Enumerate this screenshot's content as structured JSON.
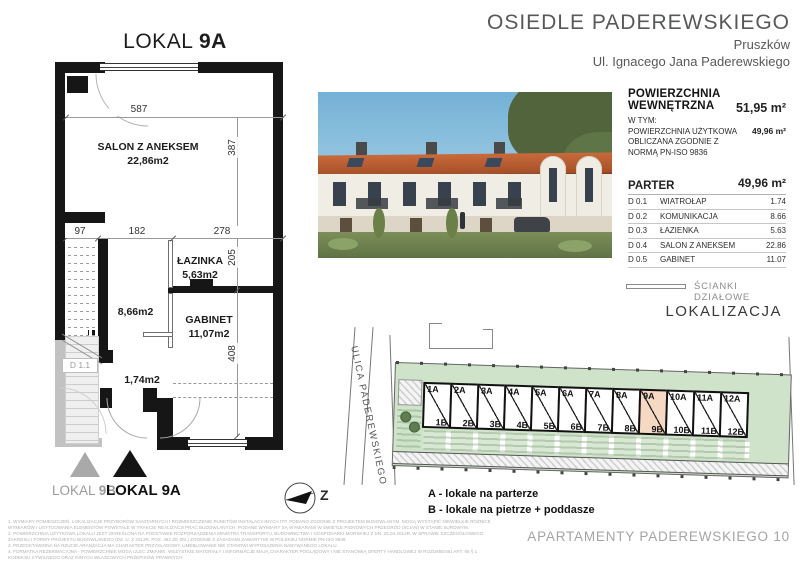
{
  "colors": {
    "wall": "#161616",
    "site_green": "#cfe3cb",
    "unit_highlight": "#f6d9c2",
    "roof_orange": "#b85c33",
    "muted_text": "#57585a"
  },
  "plan": {
    "title_prefix": "LOKAL",
    "title_number": "9A",
    "rooms": {
      "salon_name": "SALON Z ANEKSEM",
      "salon_area": "22,86m2",
      "lazienka_name": "ŁAZINKA",
      "lazienka_area": "5,63m2",
      "komunikacja_area": "8,66m2",
      "gabinet_name": "GABINET",
      "gabinet_area": "11,07m2",
      "wiatrolap_area": "1,74m2",
      "door_tag": "D 1.1"
    },
    "dims": {
      "top": "587",
      "right_upper": "387",
      "w1": "97",
      "w2": "182",
      "w3": "278",
      "right_mid": "205",
      "right_lower": "408"
    },
    "markers": {
      "gray_prefix": "LOKAL ",
      "gray_number": "9B",
      "black_prefix": "LOKAL ",
      "black_number": "9A"
    },
    "compass_letter": "Z"
  },
  "header": {
    "project": "OSIEDLE PADEREWSKIEGO",
    "city": "Pruszków",
    "street": "Ul. Ignacego Jana Paderewskiego"
  },
  "summary": {
    "internal_label": "POWIERZCHNIA WEWNĘTRZNA",
    "internal_value": "51,95 m²",
    "including": "W TYM:",
    "usable_lines": [
      "POWIERZCHNIA UŻYTKOWA",
      "OBLICZANA ZGODNIE Z",
      "NORMĄ PN-ISO 9836"
    ],
    "usable_value": "49,96 m²",
    "floor_label": "PARTER",
    "floor_value": "49,96 m²"
  },
  "room_table": [
    {
      "code": "D 0.1",
      "name": "WIATROŁAP",
      "area": "1.74"
    },
    {
      "code": "D 0.2",
      "name": "KOMUNIKACJA",
      "area": "8.66"
    },
    {
      "code": "D 0.3",
      "name": "ŁAZIENKA",
      "area": "5.63"
    },
    {
      "code": "D 0.4",
      "name": "SALON Z ANEKSEM",
      "area": "22.86"
    },
    {
      "code": "D 0.5",
      "name": "GABINET",
      "area": "11.07"
    }
  ],
  "partition_legend": "ŚCIANKI DZIAŁOWE",
  "location": {
    "title": "LOKALIZACJA",
    "street": "ULICA PADEREWSKIEGO",
    "units": [
      {
        "a": "1A",
        "b": "1B"
      },
      {
        "a": "2A",
        "b": "2B"
      },
      {
        "a": "3A",
        "b": "3B"
      },
      {
        "a": "4A",
        "b": "4B"
      },
      {
        "a": "5A",
        "b": "5B"
      },
      {
        "a": "6A",
        "b": "6B"
      },
      {
        "a": "7A",
        "b": "7B"
      },
      {
        "a": "8A",
        "b": "8B"
      },
      {
        "a": "9A",
        "b": "9B",
        "highlight": true
      },
      {
        "a": "10A",
        "b": "10B"
      },
      {
        "a": "11A",
        "b": "11B"
      },
      {
        "a": "12A",
        "b": "12B"
      }
    ],
    "legend_a": "A - lokale na parterze",
    "legend_b": "B - lokale na pietrze + poddasze"
  },
  "footer": "APARTAMENTY PADEREWSKIEGO 10",
  "disclaimer": [
    "1. WYMIARY POMIESZCZEŃ, LOKALIZACJE PRZYBORÓW SANITARNYCH I ROZMIESZCZENIE PUNKTÓW INSTALACYJNYCH ITP. PODANO ZGODNIE Z PROJEKTEM BUDOWLANYM. MOGĄ WYSTĄPIĆ NIEWIELKIE RÓŻNICE",
    "WYMIARÓW I USYTUOWANIA ELEMENTÓW POWSTAŁE W TRAKCIE REALIZACJI PRAC BUDOWLANYCH. PODANE WYMIARY SĄ WYMIARAMI W ŚWIETLE PIONOWYCH PRZEGRÓD (ŚCIAN) W STANIE SUROWYM.",
    "2. POWIERZCHNIA UŻYTKOWA LOKALU JEST OKREŚLONA NA PODSTAWIE ROZPORZĄDZENIA MINISTRA TRANSPORTU, BUDOWNICTWA I GOSPODARKI MORSKIEJ Z DN. 25.04.2012R. W SPRAWIE SZCZEGÓŁOWEGO",
    "ZAKRESU I FORMY PROJEKTU BUDOWLANEGO (DZ. U. Z 2012R. POZ. 462 ZE ZM.) ZGODNIE Z ZASADAMI ZAWARTYMI W POLSKIEJ NORMIE PN-ISO 9836.",
    "3. PRZEDSTAWIONA NA RZUCIE ARANŻACJA MA CHARAKTER PRZYKŁADOWY. UMEBLOWANIE NIE STANOWI WYPOSAŻENIA NABYWANEGO LOKALU.",
    "4. FORMATKA REZERWACYJNA - POWIERZCHNIE MOGĄ ULEC ZMIANIE. WSZYSTKIE MATERIAŁY I INFORMACJE MAJĄ CHARAKTER POGLĄDOWY I NIE STANOWIĄ OFERTY HANDLOWEJ W ROZUMIENIU ART. 66 § 1",
    "KODEKSU CYWILNEGO ORAZ INNYCH WŁAŚCIWYCH PRZEPISÓW PRAWNYCH."
  ]
}
